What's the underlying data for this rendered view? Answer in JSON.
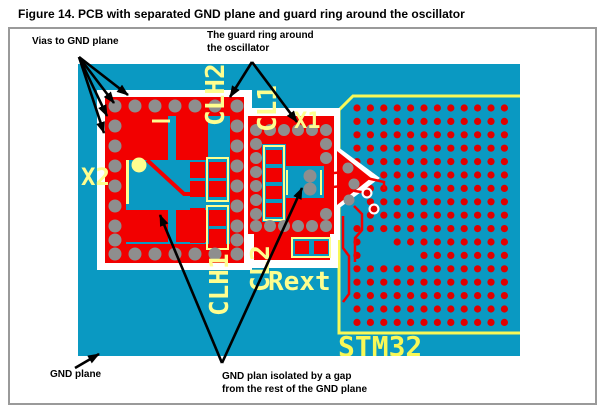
{
  "figure": {
    "title": "Figure 14. PCB with separated GND plane and guard ring around the oscillator"
  },
  "annotations": {
    "vias_label": "Vias to GND plane",
    "guard_label_line1": "The guard ring around",
    "guard_label_line2": "the oscillator",
    "gnd_plane_label": "GND plane",
    "isolated_label_line1": "GND plan isolated by a gap",
    "isolated_label_line2": "from the rest of the GND plane"
  },
  "pcb": {
    "silkscreen": {
      "x1": "X1",
      "x2": "X2",
      "cl1": "CL1",
      "cl2": "CL2",
      "clh1": "CLH1",
      "clh2": "CLH2",
      "rext": "Rext",
      "stm32": "STM32"
    },
    "colors": {
      "board": "#0A99C2",
      "copper": "#F20000",
      "via": "#8E8E8E",
      "silk_text": "#FEFE8F",
      "chip_outline": "#F8F857",
      "pin_dot": "#E00000",
      "gap": "#FFFFFF"
    },
    "vias": [
      [
        37,
        42,
        6.5
      ],
      [
        57,
        42,
        6.5
      ],
      [
        77,
        42,
        6.5
      ],
      [
        97,
        42,
        6.5
      ],
      [
        117,
        42,
        6.5
      ],
      [
        137,
        42,
        6.5
      ],
      [
        159,
        42,
        6.5
      ],
      [
        37,
        190,
        6.5
      ],
      [
        57,
        190,
        6.5
      ],
      [
        77,
        190,
        6.5
      ],
      [
        97,
        190,
        6.5
      ],
      [
        117,
        190,
        6.5
      ],
      [
        137,
        190,
        6.5
      ],
      [
        159,
        190,
        6.5
      ],
      [
        37,
        62,
        6.5
      ],
      [
        37,
        82,
        6.5
      ],
      [
        37,
        102,
        6.5
      ],
      [
        37,
        122,
        6.5
      ],
      [
        37,
        142,
        6.5
      ],
      [
        37,
        162,
        6.5
      ],
      [
        37,
        176,
        6.5
      ],
      [
        159,
        62,
        6.5
      ],
      [
        159,
        82,
        6.5
      ],
      [
        159,
        102,
        6.5
      ],
      [
        159,
        122,
        6.5
      ],
      [
        159,
        142,
        6.5
      ],
      [
        159,
        162,
        6.5
      ],
      [
        159,
        176,
        6.5
      ],
      [
        178,
        66,
        6
      ],
      [
        192,
        66,
        6
      ],
      [
        206,
        66,
        6
      ],
      [
        220,
        66,
        6
      ],
      [
        234,
        66,
        6
      ],
      [
        248,
        66,
        6
      ],
      [
        178,
        162,
        6
      ],
      [
        192,
        162,
        6
      ],
      [
        206,
        162,
        6
      ],
      [
        220,
        162,
        6
      ],
      [
        234,
        162,
        6
      ],
      [
        248,
        162,
        6
      ],
      [
        178,
        80,
        6
      ],
      [
        178,
        94,
        6
      ],
      [
        178,
        108,
        6
      ],
      [
        178,
        122,
        6
      ],
      [
        178,
        136,
        6
      ],
      [
        178,
        150,
        6
      ],
      [
        248,
        80,
        6
      ],
      [
        248,
        94,
        6
      ],
      [
        248,
        150,
        6
      ],
      [
        232,
        112,
        6.5
      ],
      [
        232,
        125,
        6.5
      ],
      [
        270,
        104,
        5.5
      ],
      [
        276,
        120,
        5.5
      ],
      [
        271,
        136,
        5.5
      ]
    ],
    "stm32_grid": {
      "cols": 12,
      "rows": 17,
      "x0": 279,
      "y0": 44,
      "step": 13.4,
      "radius": 3.6,
      "holes": [
        [
          0,
          7
        ],
        [
          0,
          8
        ],
        [
          1,
          10
        ],
        [
          2,
          10
        ],
        [
          1,
          11
        ],
        [
          2,
          11
        ],
        [
          3,
          11
        ],
        [
          4,
          11
        ]
      ]
    },
    "halo_pads": [
      [
        289,
        129
      ],
      [
        296,
        145
      ]
    ]
  }
}
